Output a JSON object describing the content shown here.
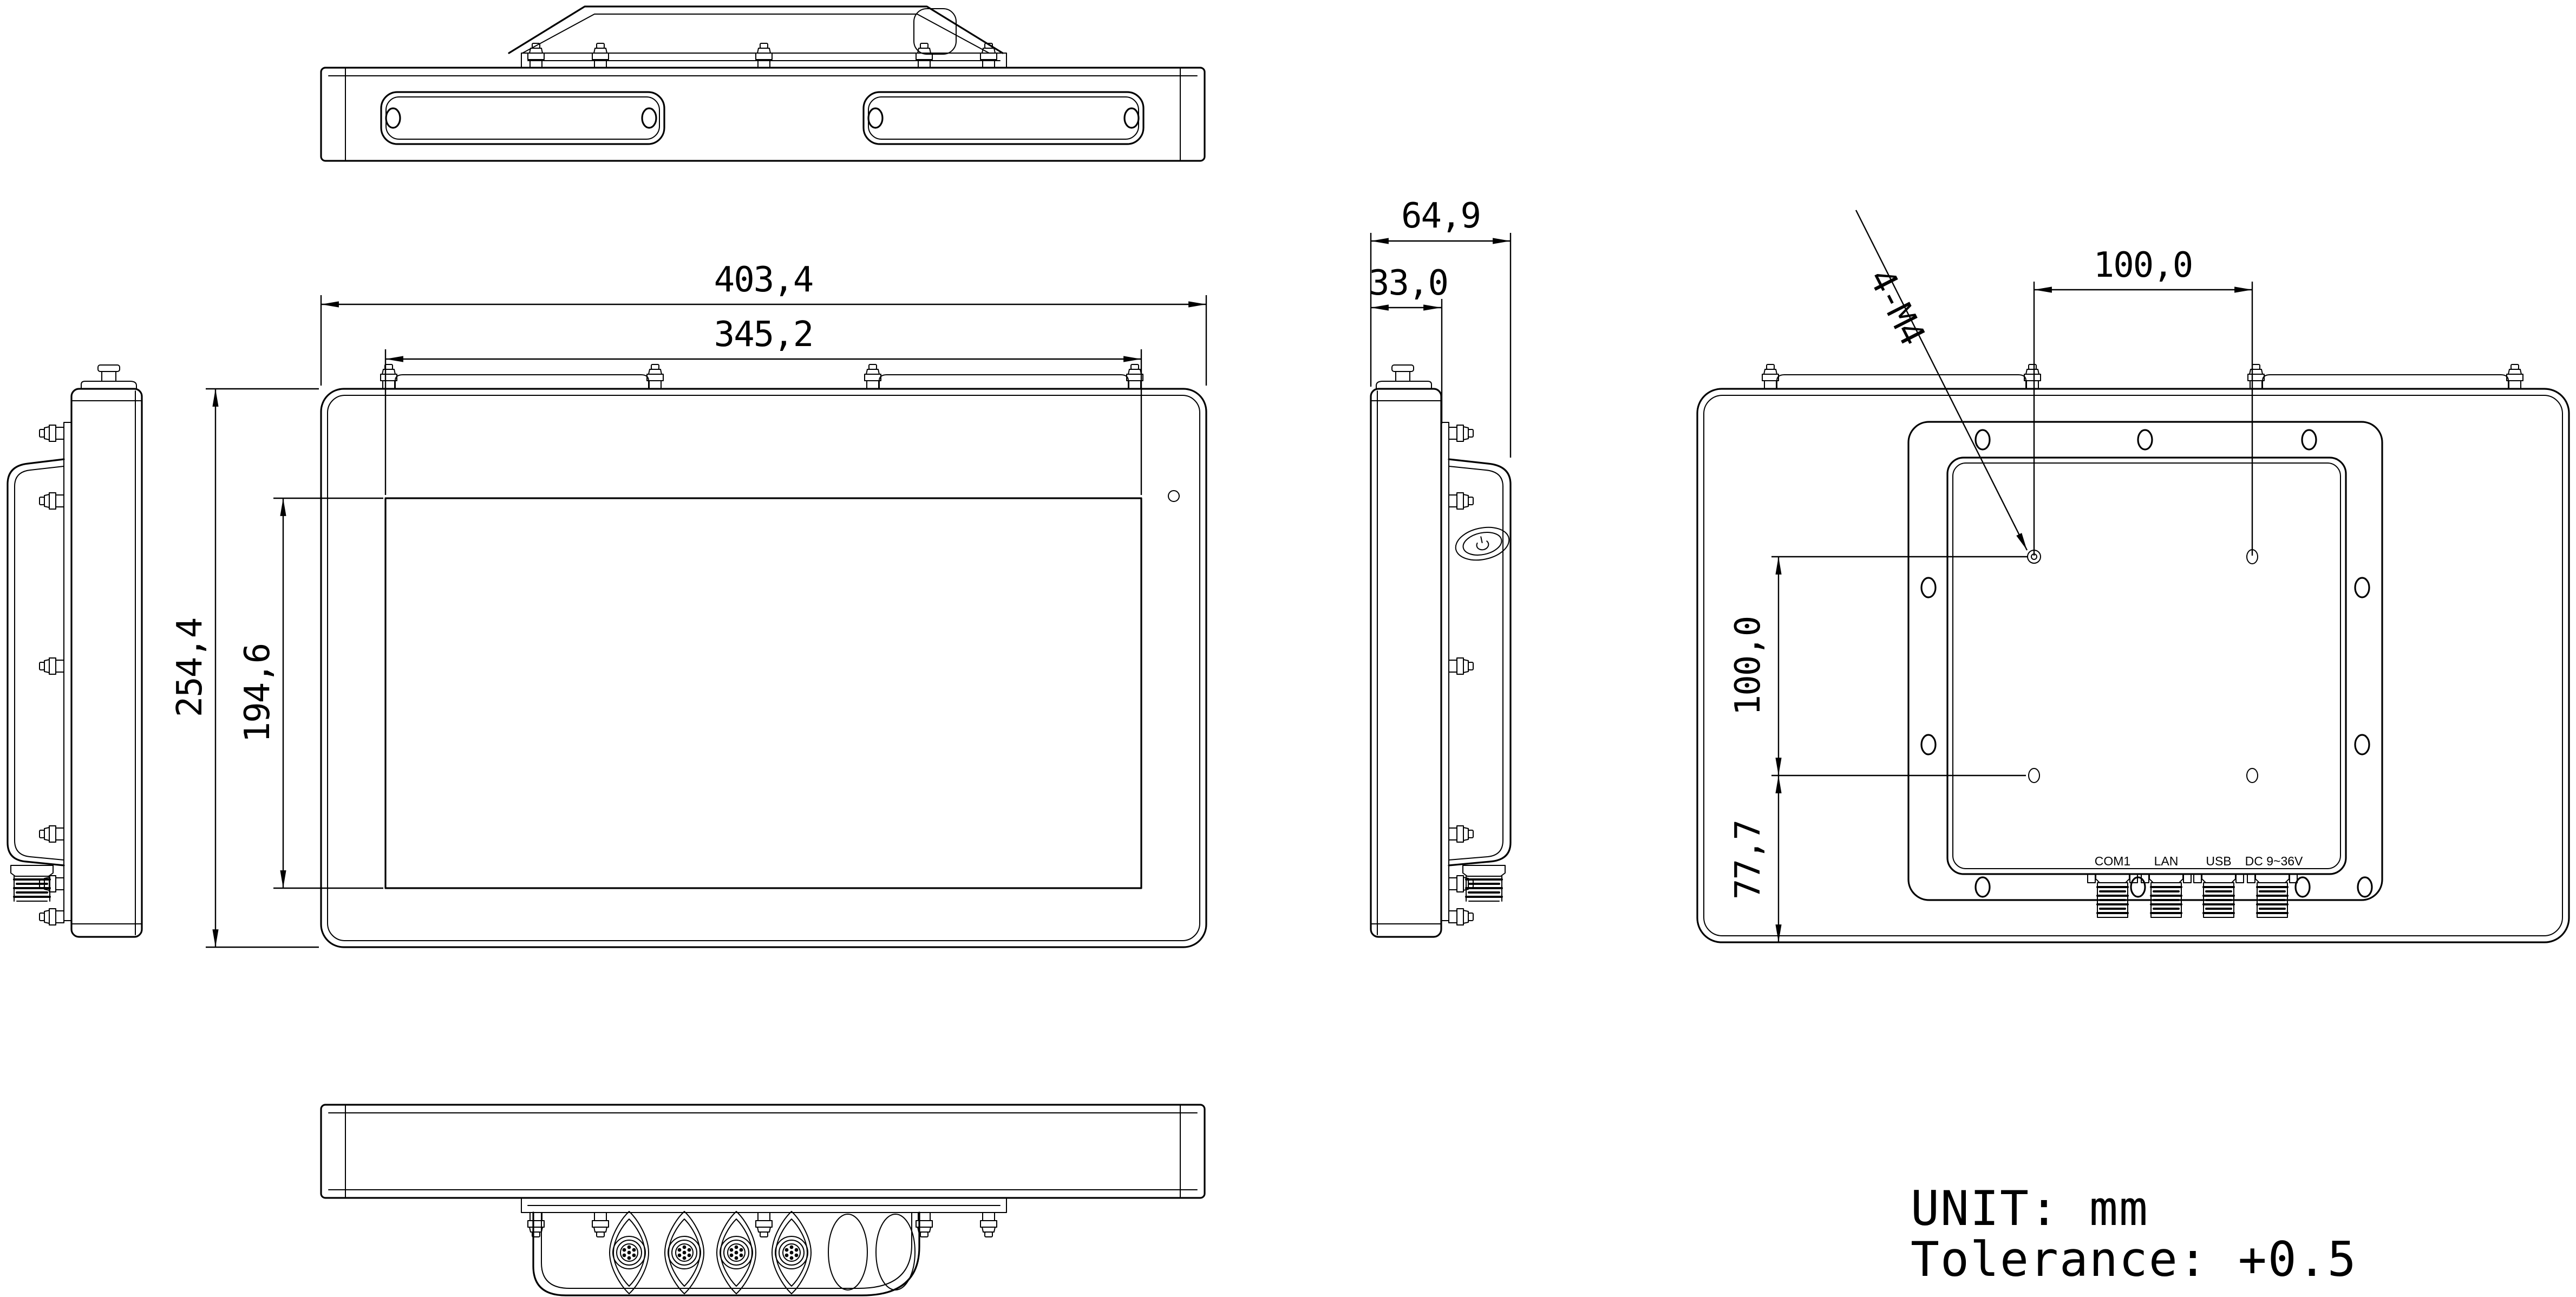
{
  "drawing": {
    "background": "#ffffff",
    "line_color": "#000000",
    "dimensions": {
      "overall_width": "403,4",
      "display_width": "345,2",
      "overall_height": "254,4",
      "display_height": "194,6",
      "total_depth": "64,9",
      "front_depth": "33,0",
      "vesa_width": "100,0",
      "vesa_height": "100,0",
      "vesa_bottom_offset": "77,7",
      "vesa_thread": "4-M4"
    },
    "rear_ports": [
      {
        "label": "COM1"
      },
      {
        "label": "LAN"
      },
      {
        "label": "USB"
      },
      {
        "label": "DC 9~36V"
      }
    ],
    "notes": {
      "unit": "UNIT: mm",
      "tolerance": "Tolerance: +0.5"
    }
  }
}
